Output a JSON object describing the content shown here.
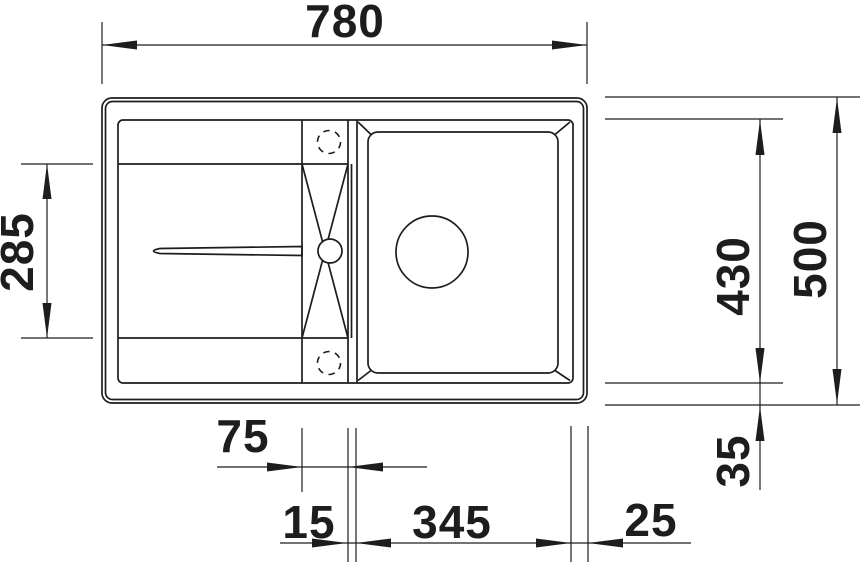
{
  "drawing": {
    "kind": "technical-dimension-drawing",
    "view": "top-view",
    "subject": "inset kitchen sink with drainboard, center tap strip and single bowl",
    "line_color": "#1d1d1b",
    "background_color": "#ffffff"
  },
  "dimensions": {
    "overall_width": "780",
    "drainer_section_depth": "285",
    "bowl_section_depth": "430",
    "overall_depth": "500",
    "center_strip_width": "75",
    "strip_to_bowl_gap": "15",
    "bowl_width": "345",
    "bowl_to_right_edge": "25",
    "bowl_to_bottom_edge": "35"
  }
}
